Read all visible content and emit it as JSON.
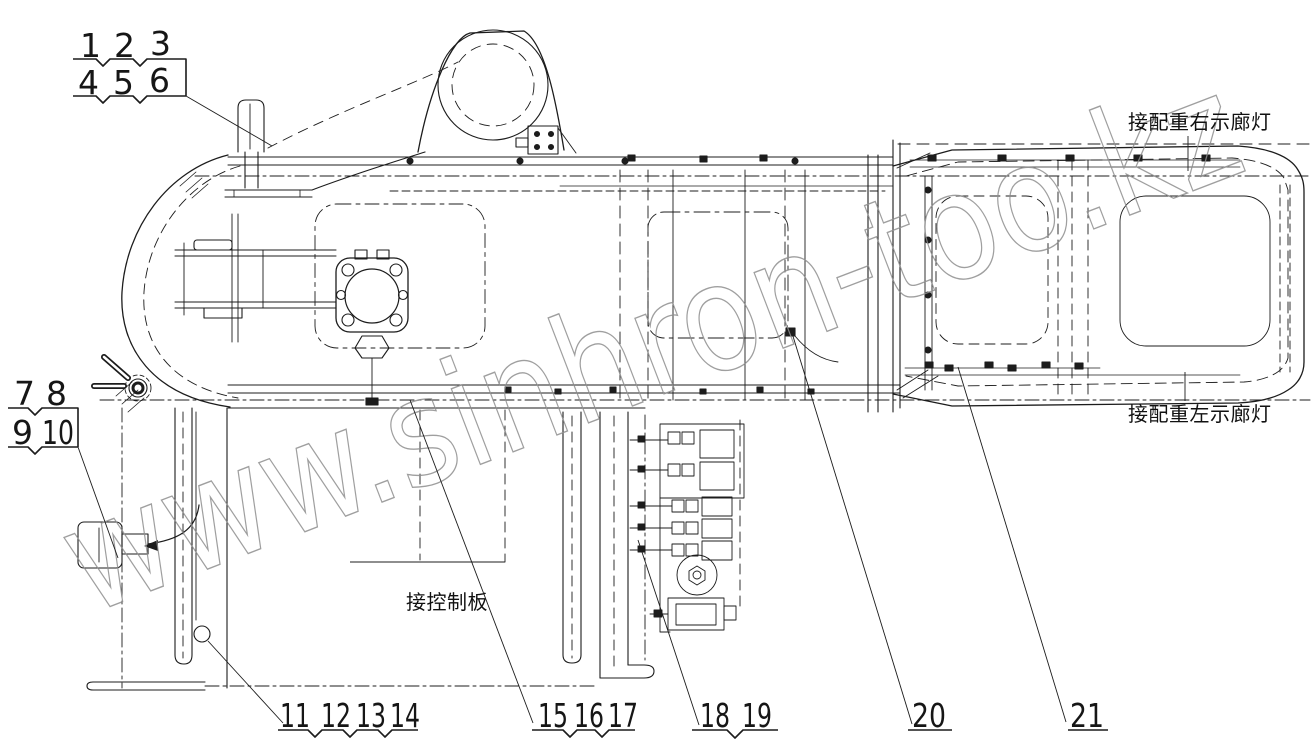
{
  "drawing": {
    "type": "technical-wiring-diagram",
    "callout_numbers": [
      "1",
      "2",
      "3",
      "4",
      "5",
      "6",
      "7",
      "8",
      "9",
      "10",
      "11",
      "12",
      "13",
      "14",
      "15",
      "16",
      "17",
      "18",
      "19",
      "20",
      "21"
    ],
    "labels": {
      "counterweight_right_marker_light": "接配重右示廊灯",
      "counterweight_left_marker_light": "接配重左示廊灯",
      "control_panel": "接控制板"
    },
    "watermark": {
      "text": "www.sinhron-too.kz",
      "color": "#8f8f8f"
    },
    "colors": {
      "background": "#ffffff",
      "line": "#1c1c1c",
      "text": "#161616"
    }
  }
}
